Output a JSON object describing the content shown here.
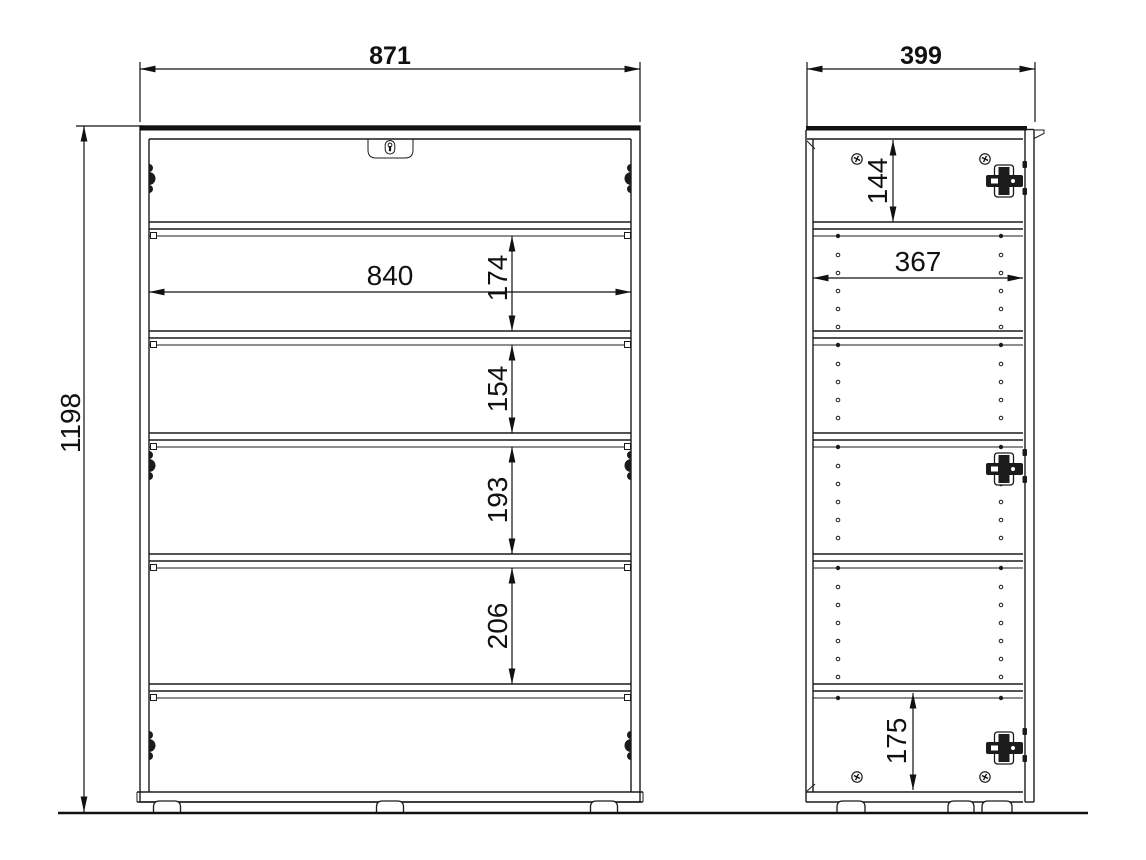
{
  "front_view": {
    "overall_width": "871",
    "overall_height": "1198",
    "inner_width": "840",
    "gap_1": "174",
    "gap_2": "154",
    "gap_3": "193",
    "gap_4": "206"
  },
  "side_view": {
    "overall_depth": "399",
    "top_gap": "144",
    "inner_depth": "367",
    "bottom_gap": "175"
  }
}
